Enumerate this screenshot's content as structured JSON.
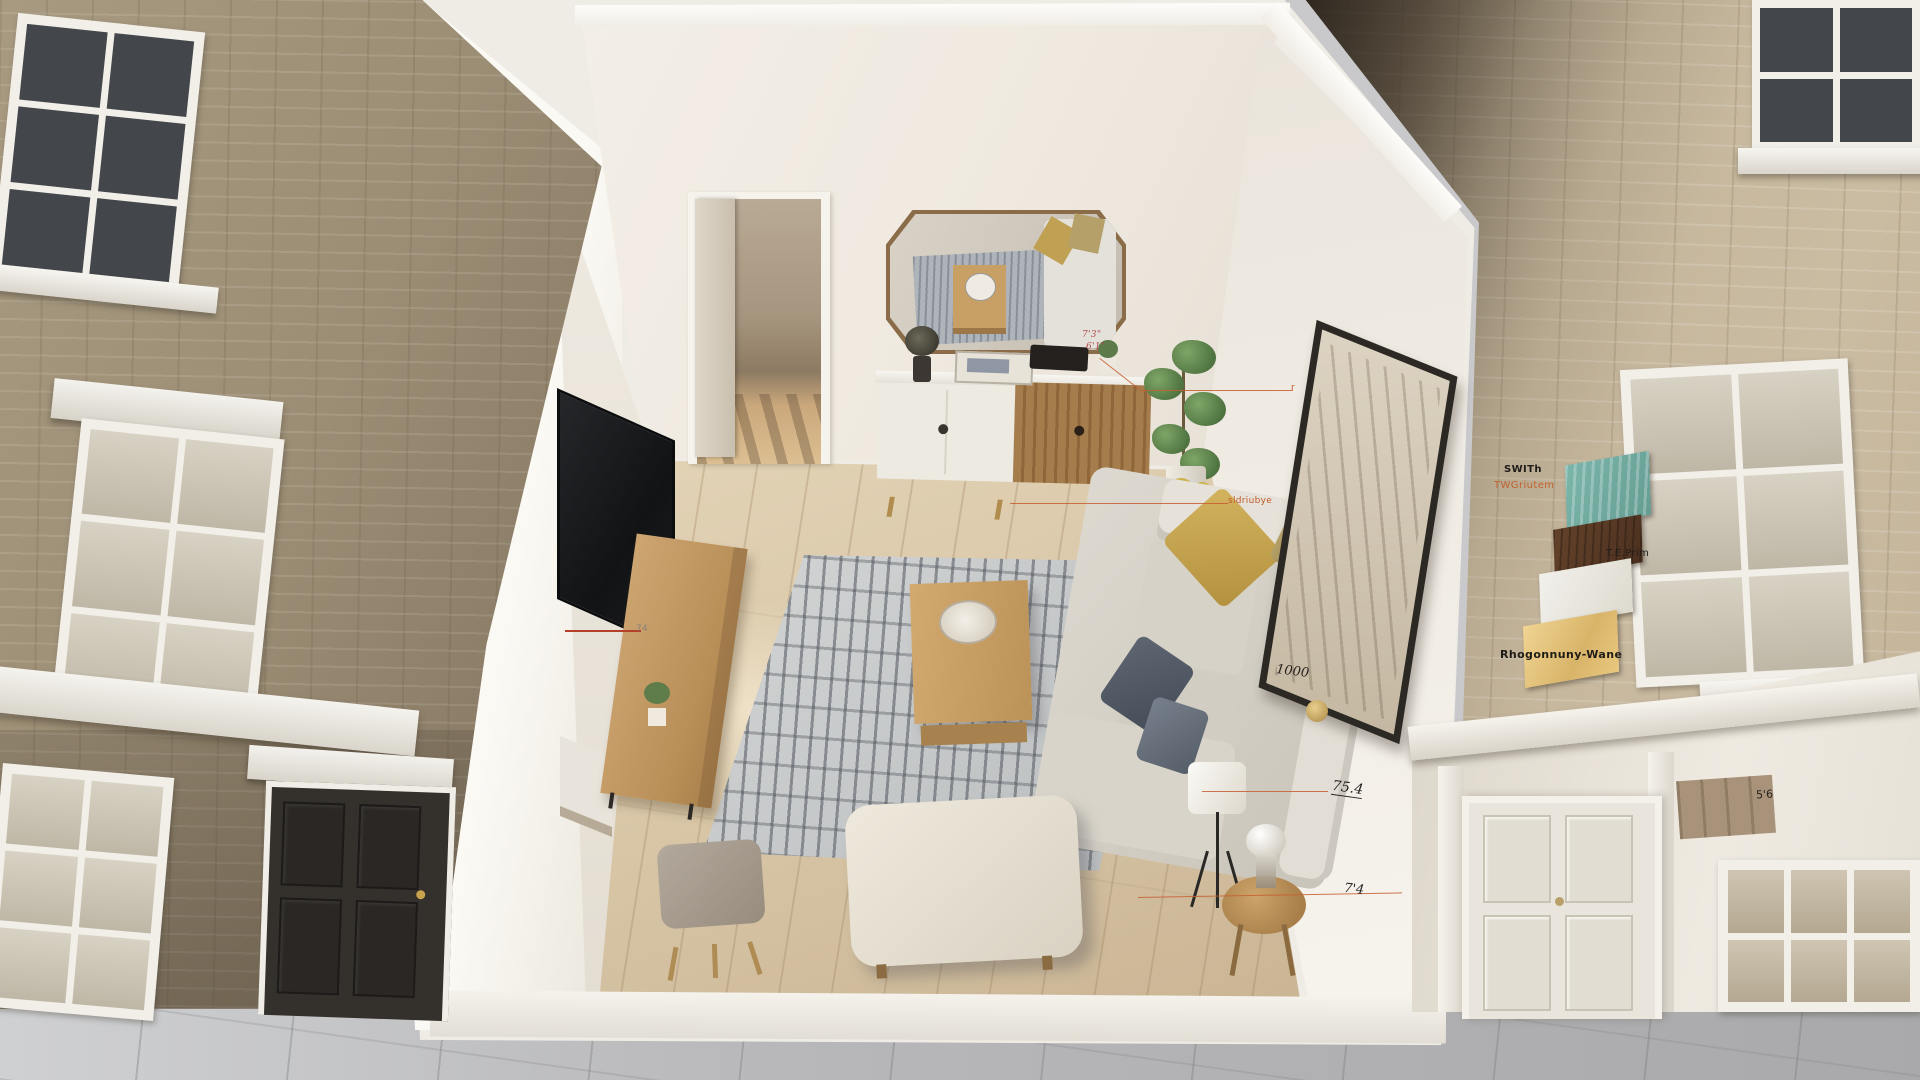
{
  "annotations": {
    "mirror_height_line1": "7'3\"",
    "mirror_height_line2": "6'1\"",
    "tv_width_mark": "74",
    "wall_mark": "1000",
    "art_height_mark": "75.4",
    "side_table_height_mark": "7'4",
    "facade_mark": "5'6",
    "wall_finish_label": "sldriubye",
    "frame_pointer_mark": "r"
  },
  "materials_legend": {
    "heading_primary": "SWITh",
    "heading_secondary": "TWGriutem",
    "finish_label": "T.E.Prim",
    "bottom_label": "Rhogonnuny-Wane",
    "chips": [
      {
        "name": "teal-wood-panel",
        "color": "#74b0a5"
      },
      {
        "name": "walnut-veneer",
        "color": "#5e3d27"
      },
      {
        "name": "matte-white-paint",
        "color": "#ecebe6"
      },
      {
        "name": "brushed-brass",
        "color": "#e6c57f"
      }
    ]
  },
  "palette": {
    "annotation_orange": "#c65f2e",
    "left_brick": "#a3947c",
    "right_brick": "#c7b99f",
    "wall_white": "#f2efe8",
    "floor_wood": "#d7c4a5",
    "rug_grey": "#bfc2c4",
    "pavement_grey": "#b5b5b7"
  }
}
